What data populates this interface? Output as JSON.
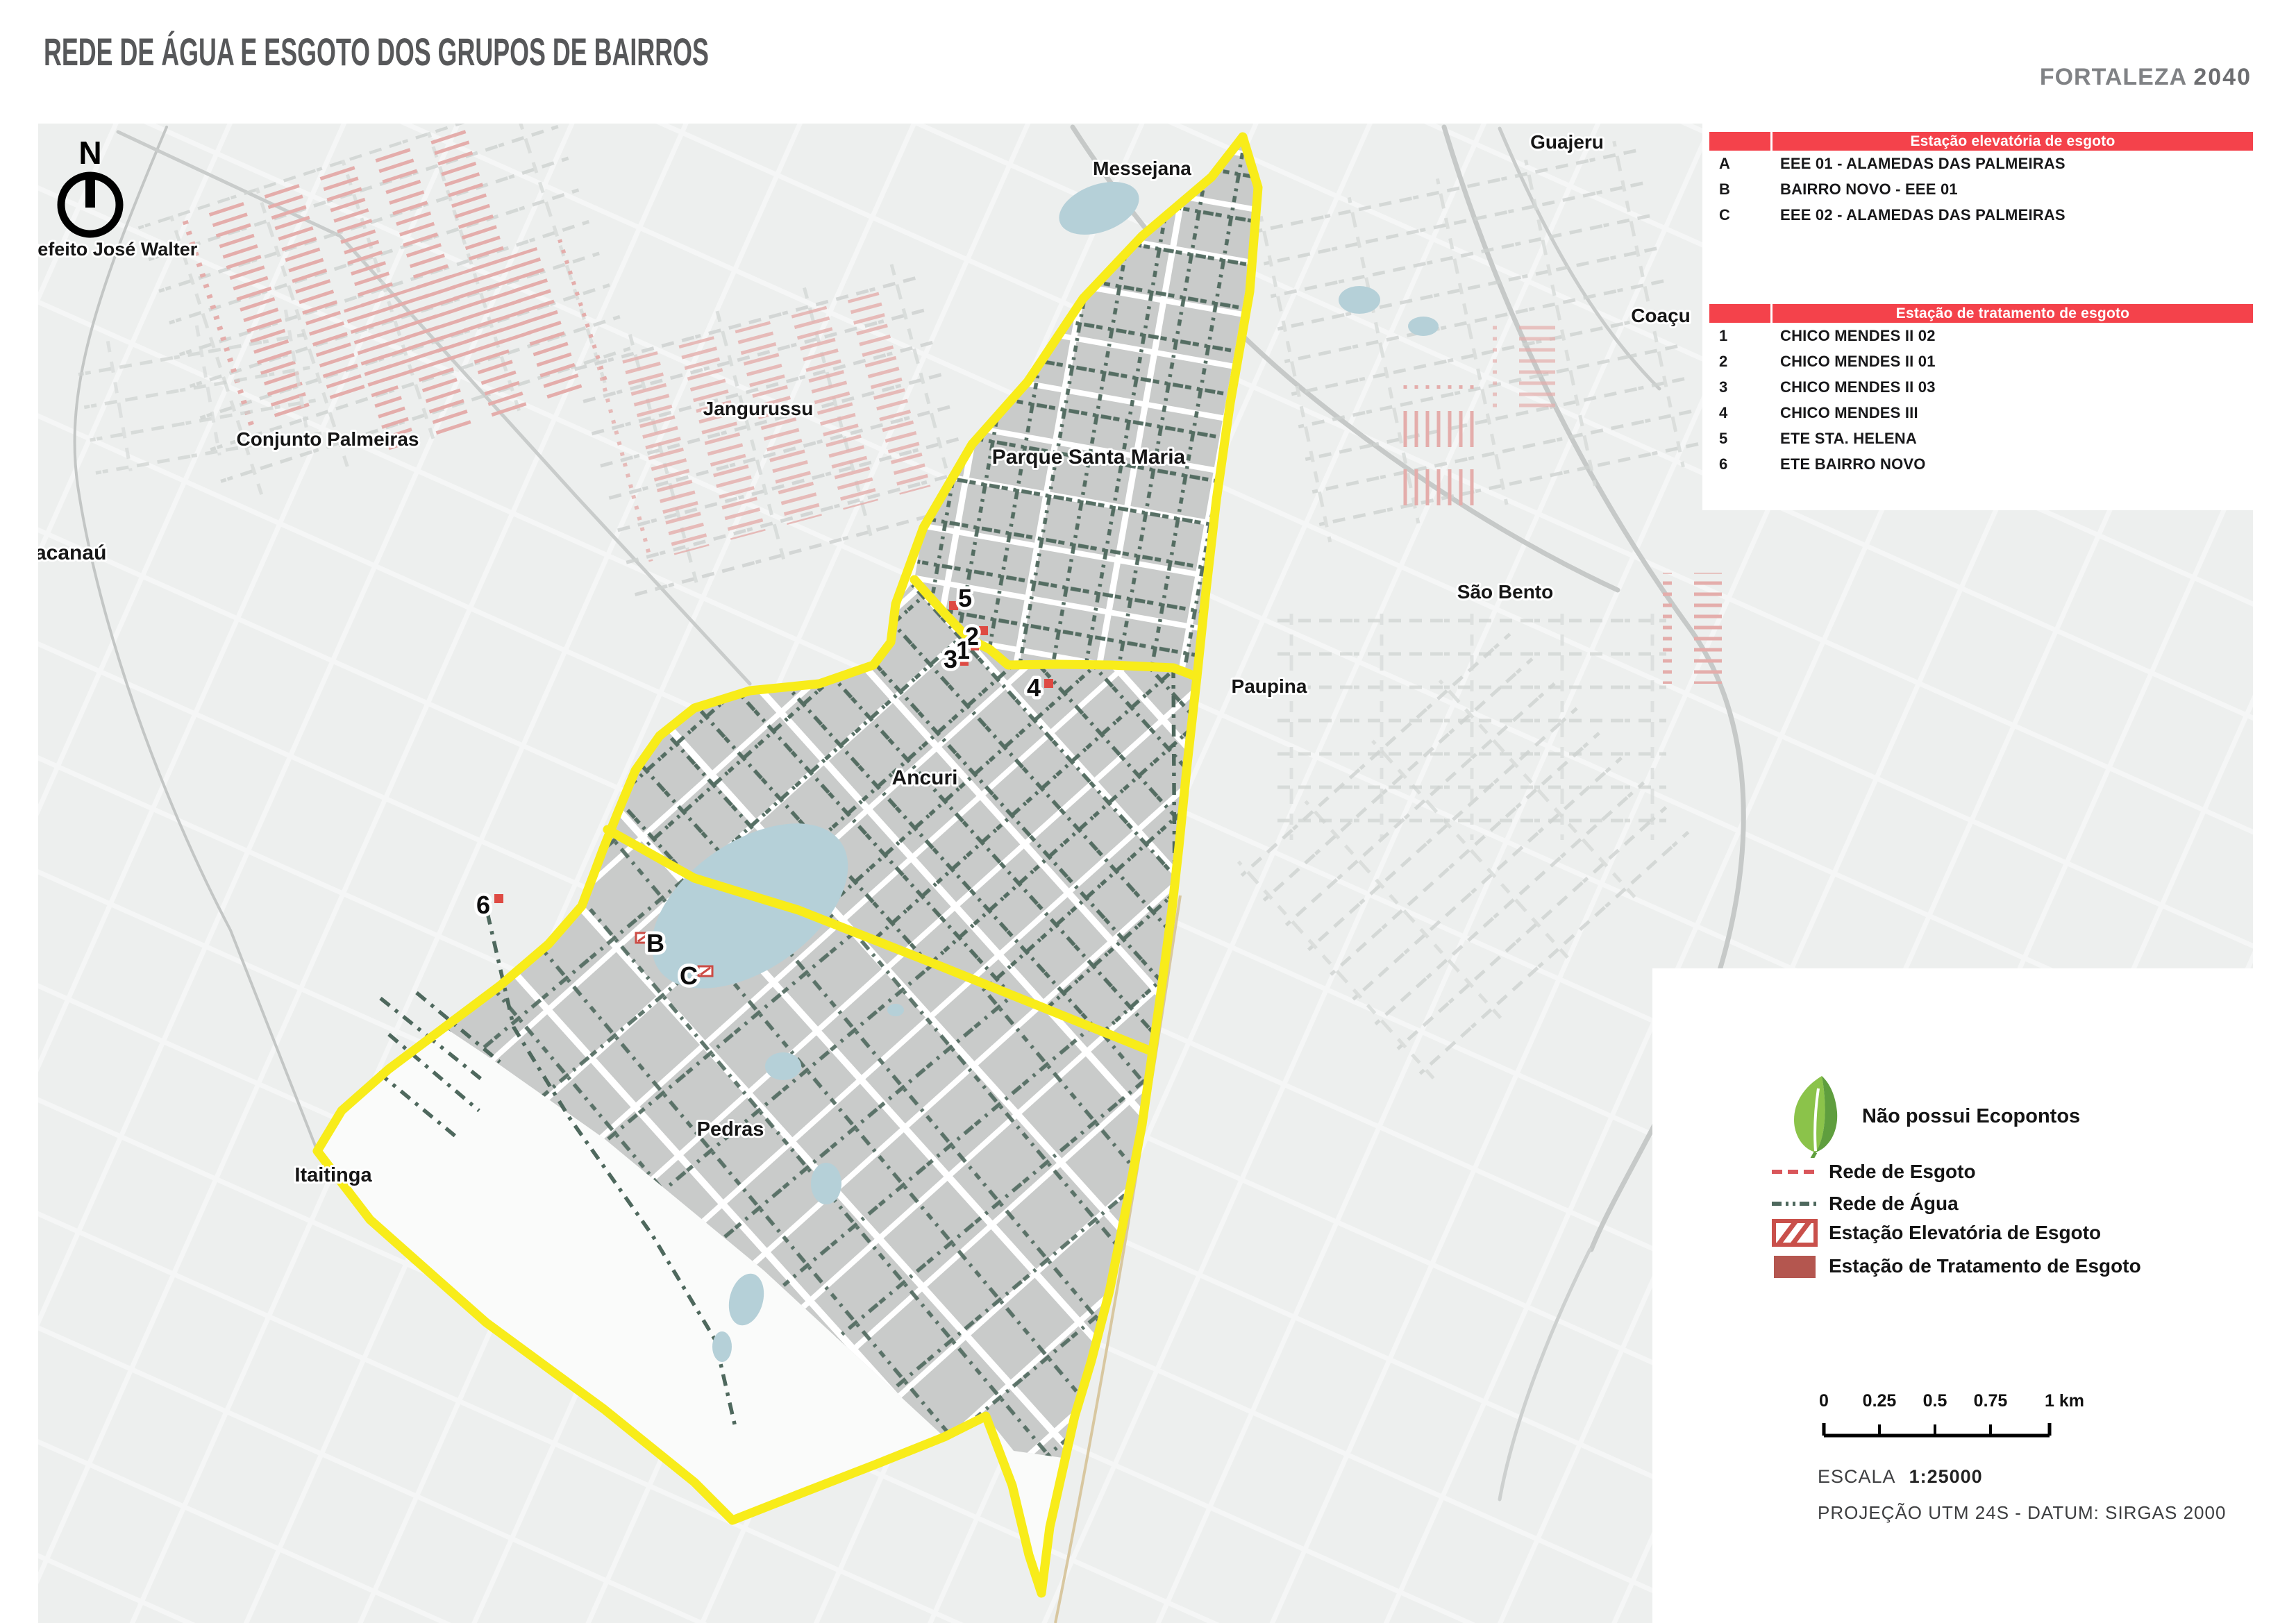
{
  "header": {
    "title": "REDE DE ÁGUA E ESGOTO DOS GRUPOS DE BAIRROS",
    "brand": "FORTALEZA",
    "brand_year": "2040"
  },
  "stations_elevatoria": {
    "title": "Estação elevatória de esgoto",
    "rows": [
      {
        "id": "A",
        "name": "EEE 01 -  ALAMEDAS DAS PALMEIRAS"
      },
      {
        "id": "B",
        "name": "BAIRRO NOVO - EEE 01"
      },
      {
        "id": "C",
        "name": "EEE 02 - ALAMEDAS DAS PALMEIRAS"
      }
    ]
  },
  "stations_tratamento": {
    "title": "Estação de tratamento de esgoto",
    "rows": [
      {
        "id": "1",
        "name": "CHICO MENDES II 02"
      },
      {
        "id": "2",
        "name": "CHICO MENDES II 01"
      },
      {
        "id": "3",
        "name": "CHICO MENDES II 03"
      },
      {
        "id": "4",
        "name": "CHICO MENDES III"
      },
      {
        "id": "5",
        "name": "ETE STA. HELENA"
      },
      {
        "id": "6",
        "name": "ETE BAIRRO NOVO"
      }
    ]
  },
  "compass": {
    "north": "N",
    "label": "Prefeito José Walter"
  },
  "map_labels": {
    "messejana": "Messejana",
    "guajeru": "Guajeru",
    "coacu": "Coaçu",
    "jangurussu": "Jangurussu",
    "conjunto_palmeiras": "Conjunto Palmeiras",
    "maracanau": "acanaú",
    "parque_santa_maria": "Parque Santa Maria",
    "sao_bento": "São Bento",
    "paupina": "Paupina",
    "ancuri": "Ancuri",
    "pedras": "Pedras",
    "itaitinga": "Itaitinga"
  },
  "markers": {
    "m1": "1",
    "m2": "2",
    "m3": "3",
    "m4": "4",
    "m5": "5",
    "m6": "6",
    "mB": "B",
    "mC": "C"
  },
  "legend": {
    "ecopontos": "Não possui Ecopontos",
    "rede_esgoto": "Rede de Esgoto",
    "rede_agua": "Rede de Água",
    "eee": "Estação Elevatória de Esgoto",
    "ete": "Estação de Tratamento de Esgoto"
  },
  "scalebar": {
    "t0": "0",
    "t1": "0.25",
    "t2": "0.5",
    "t3": "0.75",
    "t4": "1 km",
    "escala_label": "ESCALA",
    "escala_value": "1:25000",
    "projecao": "PROJEÇÃO UTM 24S - DATUM: SIRGAS 2000"
  },
  "colors": {
    "header_red": "#f4424b",
    "boundary_yellow": "#f8ec1a",
    "water_teal": "#4e685d",
    "sewage_pink": "#e4adab",
    "ete_maroon": "#b4564f",
    "lake_blue": "#b5d0d8",
    "title_gray": "#57585a"
  }
}
